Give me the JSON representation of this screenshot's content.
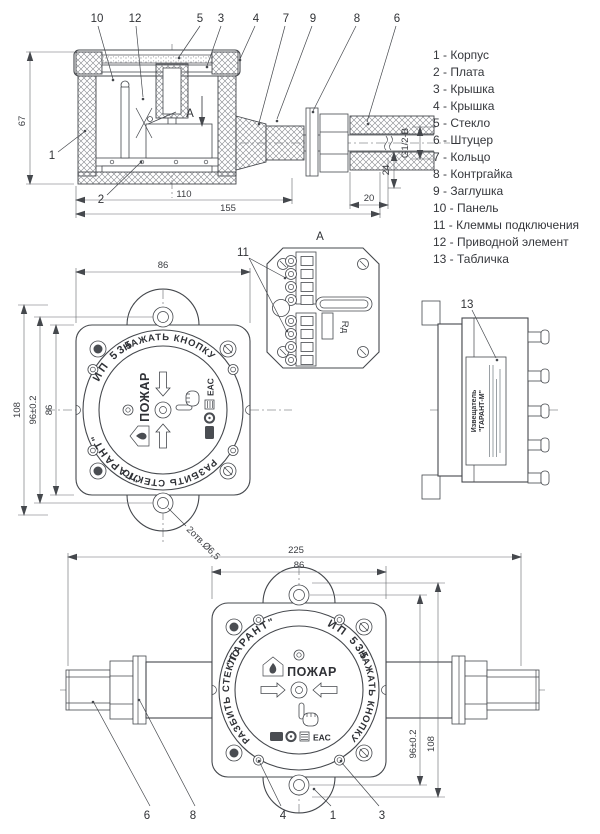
{
  "drawing": {
    "legend": {
      "items": [
        "1 - Корпус",
        "2 - Плата",
        "3 - Крышка",
        "4 - Крышка",
        "5 - Стекло",
        "6 - Штуцер",
        "7 - Кольцо",
        "8 - Контргайка",
        "9 - Заглушка",
        "10 - Панель",
        "11 - Клеммы подключения",
        "12 - Приводной элемент",
        "13 - Табличка"
      ]
    },
    "sec": {
      "arrow": "A",
      "callouts": {
        "c1": "1",
        "c2": "2",
        "c3": "3",
        "c4": "4",
        "c5": "5",
        "c6": "6",
        "c7": "7",
        "c8": "8",
        "c9": "9",
        "c10": "10",
        "c12": "12"
      },
      "dims": {
        "h67": "67",
        "w110": "110",
        "w155": "155",
        "l20": "20",
        "s24": "24",
        "thread": "G1/2-B"
      }
    },
    "viewA": {
      "label": "A",
      "c11": "11",
      "rd": "Rд"
    },
    "front": {
      "dims": {
        "w86": "86",
        "h86": "86",
        "span96": "96±0.2",
        "h108": "108",
        "holes": "2отв.Ø6,5"
      }
    },
    "side": {
      "c13": "13",
      "label_line1": "Извещатель",
      "label_line2": "\"ГАРАНТ-М\""
    },
    "bottom": {
      "dims": {
        "w225": "225",
        "w86": "86",
        "span96": "96±0.2",
        "h108": "108"
      },
      "callouts": {
        "c6": "6",
        "c8": "8",
        "c4": "4",
        "c1": "1",
        "c3": "3"
      }
    },
    "face": {
      "brand": "\"ГАРАНТ\"",
      "model": "ИП 535",
      "press": "НАЖАТЬ КНОПКУ",
      "breakglass": "РАЗБИТЬ СТЕКЛО",
      "alarm": "ПОЖАР",
      "eac": "ЕАС"
    }
  }
}
